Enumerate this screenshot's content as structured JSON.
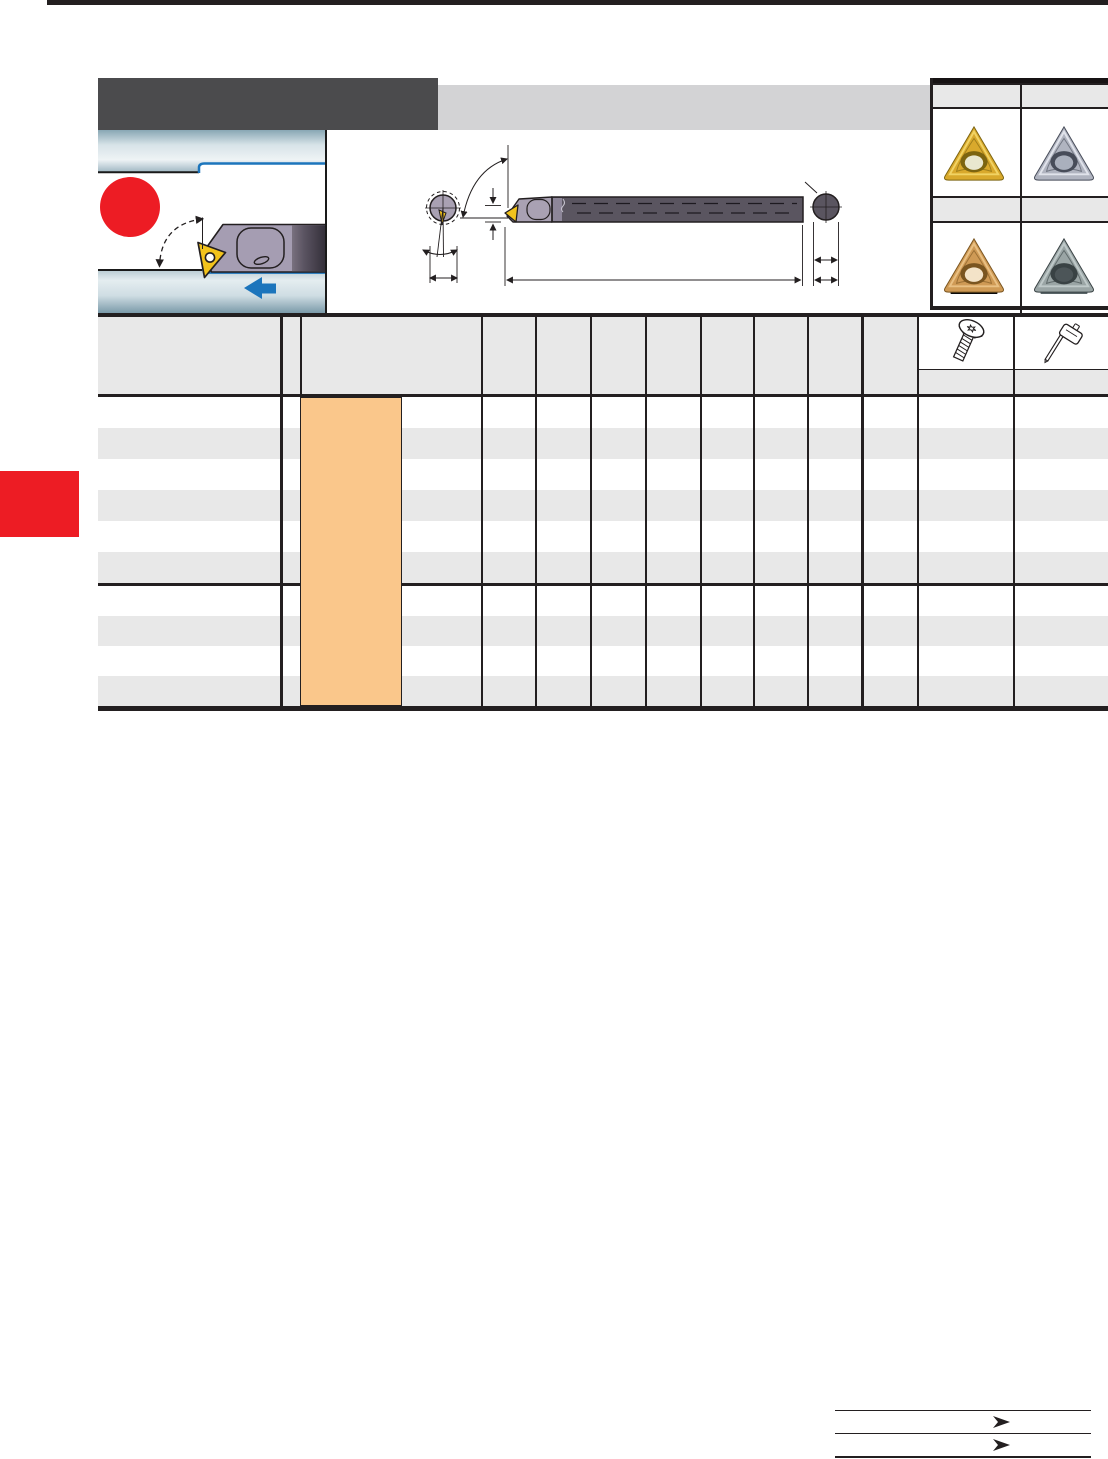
{
  "page": {
    "background": "#ffffff",
    "top_rule_color": "#231f20",
    "side_tab_color": "#ed1c24"
  },
  "banner": {
    "dark_block_color": "#4b4b4d",
    "light_block_color": "#d3d3d5"
  },
  "application_photo": {
    "workpiece_light": "#eef3f5",
    "workpiece_dark": "#7b9aa9",
    "bore_profile_color": "#1c75bc",
    "red_marker_color": "#ed1c24",
    "feed_arrow_color": "#1c75bc",
    "toolholder_color": "#a59db2",
    "insert_tip_color": "#f2c31c"
  },
  "dimension_drawing": {
    "line_color": "#231f20",
    "shank_color": "#5a5560",
    "head_color": "#a9a1b3",
    "insert_tip_color": "#f2c31c"
  },
  "insert_panel": {
    "label_band_color": "#e8e8e8",
    "inserts": [
      {
        "name": "gold-coated-insert",
        "body": "#d9a92c",
        "light": "#f4da6e",
        "dark": "#7c6410",
        "hole_inner": "#e9e7cf",
        "base_strip": ""
      },
      {
        "name": "silver-cermet-insert",
        "body": "#b0b4c0",
        "light": "#e9ebf2",
        "dark": "#474c59",
        "hole_inner": "#aab0bd",
        "base_strip": ""
      },
      {
        "name": "bronze-coated-insert",
        "body": "#cf9a55",
        "light": "#edc78c",
        "dark": "#7a5520",
        "hole_inner": "#f3e3c8",
        "base_strip": "#0b0b0b"
      },
      {
        "name": "gray-carbide-insert",
        "body": "#9aa5a5",
        "light": "#c6cfcf",
        "dark": "#394244",
        "hole_inner": "#4c5558",
        "base_strip": "#5a6668"
      }
    ]
  },
  "table": {
    "outline_color": "#231f20",
    "header_fill": "#e8e8e8",
    "stripe_fill": "#e8e8e8",
    "highlight_fill": "#fac78b",
    "row_groups": [
      6,
      4
    ],
    "spare_parts_icons": [
      "torx-screw",
      "torx-key"
    ]
  },
  "footer_nav": {
    "entries": 2,
    "arrow_color": "#231f20"
  }
}
